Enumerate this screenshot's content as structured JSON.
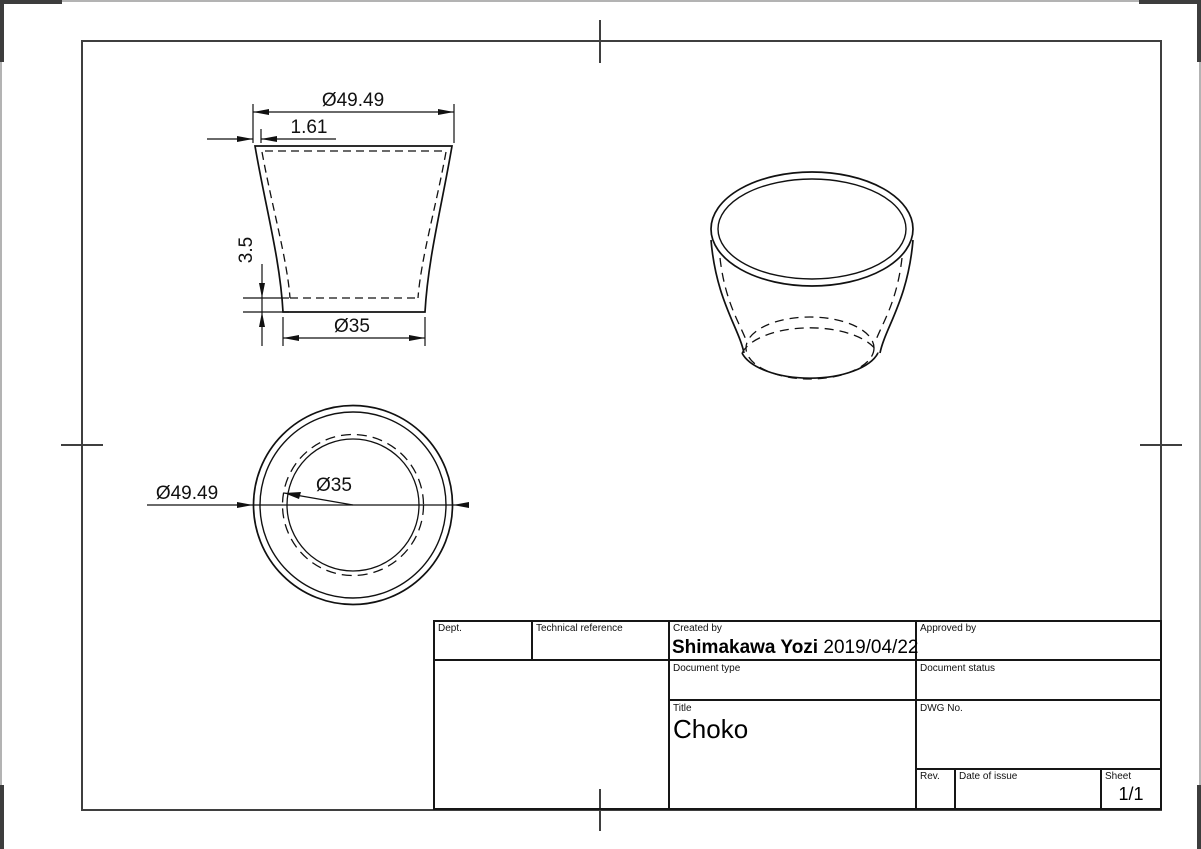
{
  "title_block": {
    "dept_label": "Dept.",
    "technical_reference_label": "Technical reference",
    "created_by_label": "Created by",
    "created_by_value": "Shimakawa Yozi",
    "created_date": "2019/04/22",
    "approved_by_label": "Approved by",
    "document_type_label": "Document type",
    "document_status_label": "Document status",
    "title_label": "Title",
    "title_value": "Choko",
    "dwg_no_label": "DWG No.",
    "rev_label": "Rev.",
    "date_of_issue_label": "Date of issue",
    "sheet_label": "Sheet",
    "sheet_value": "1/1"
  },
  "dimensions": {
    "front_view": {
      "top_diameter": "Ø49.49",
      "rim_thickness": "1.61",
      "base_height": "3.5",
      "bottom_diameter": "Ø35"
    },
    "top_view": {
      "outer_diameter": "Ø49.49",
      "bottom_diameter": "Ø35"
    }
  },
  "colors": {
    "drawing_line": "#111111",
    "frame_line": "#3f3f3f",
    "window_edge": "#b3b3b3"
  }
}
